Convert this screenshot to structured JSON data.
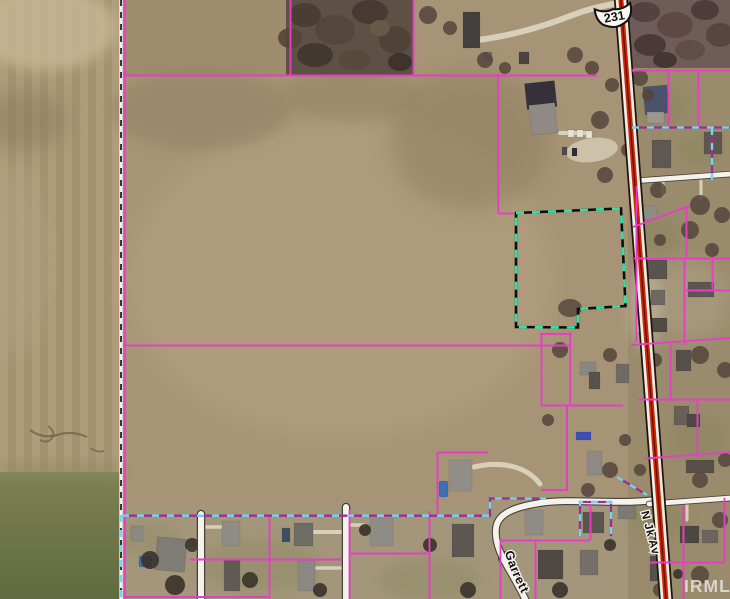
{
  "map": {
    "watermark": "IRMLS",
    "labels": {
      "highway_shield": "231",
      "road_vertical": "N Jk Av",
      "road_curve": "Garrett"
    },
    "colors": {
      "parcel_line": "#e63ec6",
      "selected_parcel_dash": "#2fe3a4",
      "boundary_dash": "#6fd8f2",
      "highway_stripe": "#ce2506",
      "road_fill": "#f4f2ea",
      "field_tan": "#a28f6e",
      "grass_green": "#6f7a4a",
      "woods_dark": "#5e5046",
      "watermark_text": "#eceae5"
    }
  }
}
